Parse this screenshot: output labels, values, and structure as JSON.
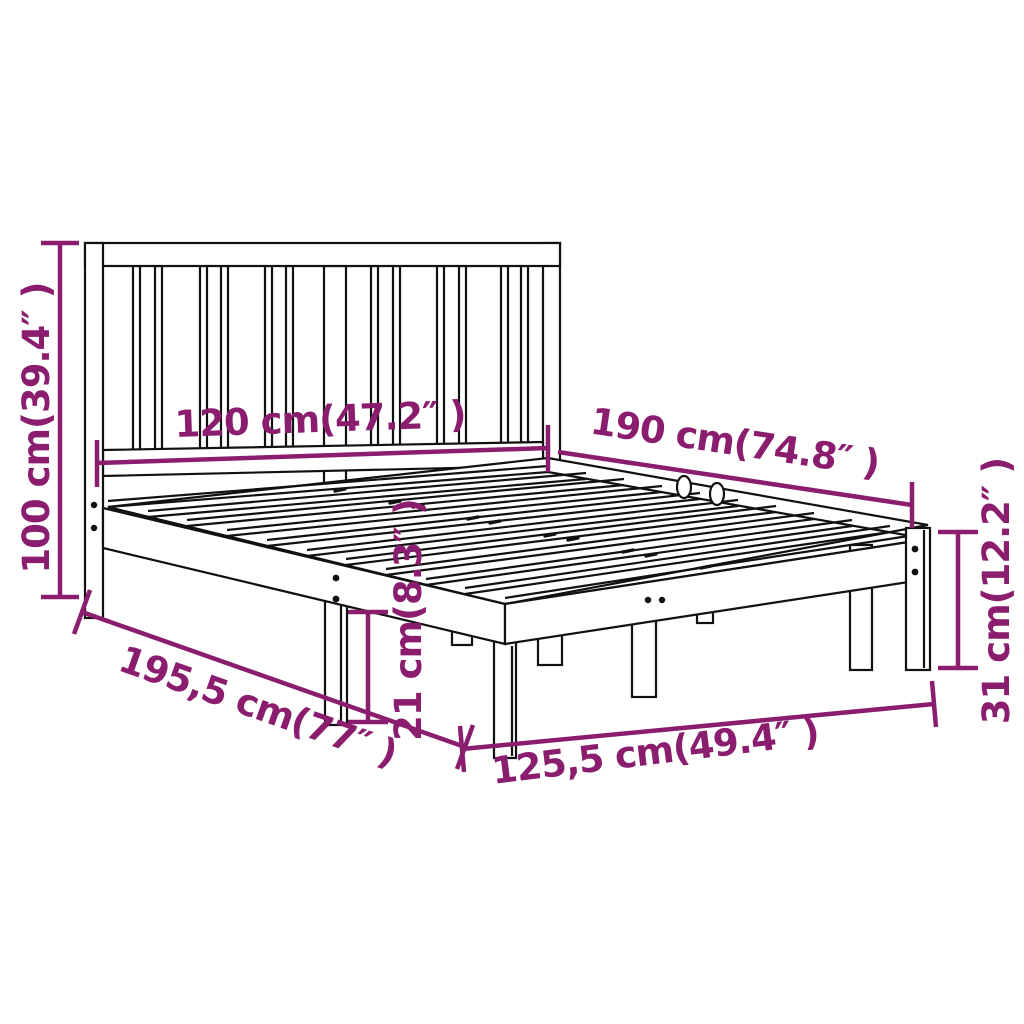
{
  "canvas": {
    "background": "#ffffff",
    "line_color": "#111111",
    "accent_color": "#8B1D6F"
  },
  "diagram": {
    "type": "product-dimension-drawing",
    "subject": "wooden bed frame with slatted headboard",
    "dimensions": [
      {
        "id": "headboard-height",
        "label": "100 cm(39.4″ )"
      },
      {
        "id": "headboard-width",
        "label": "120 cm(47.2″ )"
      },
      {
        "id": "mattress-length",
        "label": "190 cm(74.8″ )"
      },
      {
        "id": "frame-length",
        "label": "195,5 cm(77″ )"
      },
      {
        "id": "frame-width",
        "label": "125,5 cm(49.4″ )"
      },
      {
        "id": "underbed-clearance",
        "label": "21 cm(8.3″ )"
      },
      {
        "id": "footend-height",
        "label": "31 cm(12.2″ )"
      }
    ]
  }
}
